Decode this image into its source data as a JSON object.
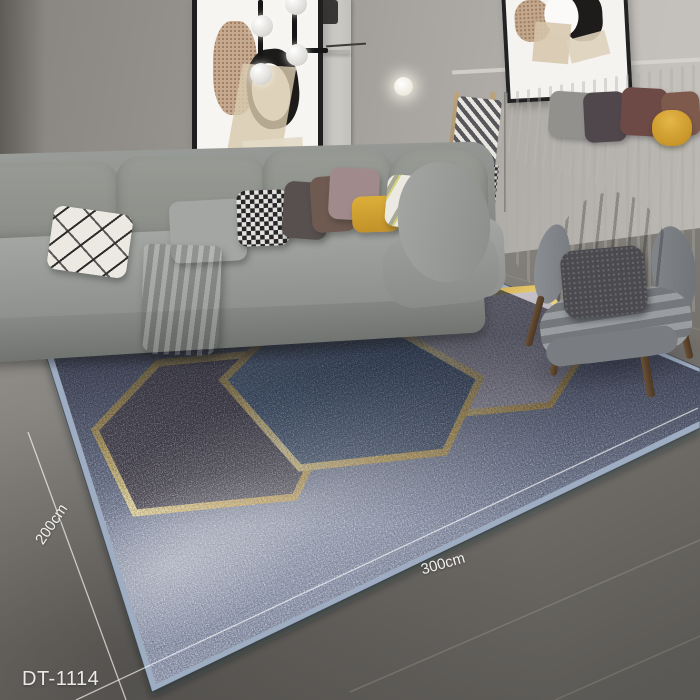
{
  "labels": {
    "depth": "200cm",
    "width": "300cm",
    "product_code": "DT-1114"
  },
  "rug": {
    "base_color": "#6b7288",
    "binding_color": "#9fadc2",
    "gold_trim_color": "#d9b254",
    "hexagon_colors": {
      "dark": "#474049",
      "blue": "#47617d",
      "light": "#c0bac2"
    }
  },
  "scene": {
    "wall_color": "#a5a29d",
    "floor_color": "#7c7974",
    "sofa_color": "#92958f",
    "chair_color": "#81858a",
    "curtain_color": "#f0eeea",
    "accent_pillow_color": "#d7a42f",
    "dimension_line_color": "#ffffff"
  }
}
